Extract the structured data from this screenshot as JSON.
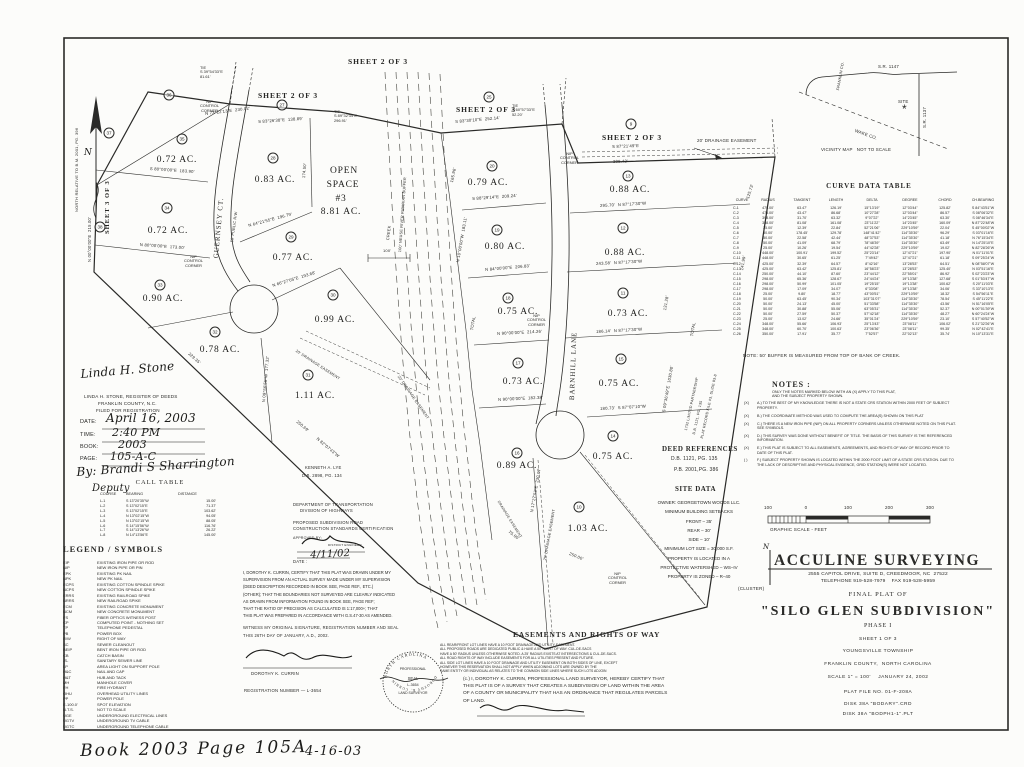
{
  "sheet_refs": {
    "s2": "SHEET 2 OF 3",
    "s3": "SHEET 3 OF 3"
  },
  "north_note": "NORTH RELATIVE TO B.M. 2001, PG. 396",
  "north_n": "N",
  "map": {
    "streets": {
      "guernsey": "GUERNSEY CT.",
      "guernsey_rw": "50' PUBLIC R/W",
      "barnhill": "BARNHILL LANE"
    },
    "creek": {
      "label": "CREEK",
      "buffer": "100' NEUSE RIVER RIPARIAN BUFFER",
      "dim": "100'"
    },
    "easements": {
      "e20": "20' DRAINAGE EASEMENT",
      "e25": "25' DRAINAGE EASEMENT",
      "edr": "DRAINAGE EASEMENT"
    },
    "control_corner": {
      "l1": "NIP",
      "l2": "CONTROL",
      "l3": "CORNER"
    },
    "ties": {
      "t1": [
        "TIE",
        "S 39°54'33\"E",
        "81.61'"
      ],
      "t2": [
        "TIE",
        "S 89°32'34\"E",
        "296.91'"
      ],
      "t3": [
        "TIE",
        "S 60°57'33\"E",
        "52.20'"
      ]
    },
    "adjoiners": {
      "lye1": "KENNETH A. LYE",
      "lye2": "D.B. 2898, PG. 134",
      "lp1": "1732 LIMITED PARTNERSHIP",
      "lp2": "D.B. 1121, PG. 135",
      "lp3": "PLAT RECORD FILE #3, SLIDE 83-8"
    },
    "open_space": {
      "l1": "OPEN",
      "l2": "SPACE",
      "l3": "#3",
      "l4": "8.81 AC."
    },
    "bearings": [
      "N 73°22'13\"E  230.02'",
      "S 80°00'00\"E  183.90'",
      "N 80°00'00\"E  173.00'",
      "S 83°26'38\"E  138.89'",
      "N 64°21'55\"E  196.79'",
      "N 66°27'05\"E  193.68'",
      "S 83°30'10\"E  252.14'",
      "S 88°29'14\"E  209.24'",
      "N 84°00'00\"E  206.83'",
      "N 90°00'00\"E  214.26'",
      "N 90°00'00\"E  182.38'",
      "S 87°21'49\"E",
      "308.42'",
      "295.70'  N 87°17'30\"W",
      "243.58'  N 87°17'30\"W",
      "186.14'  N 87°17'30\"W",
      "180.73'  S 87°07'10\"W",
      "N 00°00'00\"E  215.00'",
      "N 10°00'00\"W  183.11'",
      "174.50'",
      "165.96'",
      "229.35'",
      "250.69'",
      "250.00'",
      "75.00'",
      "N 82°07'43\"W",
      "S 09°36'49\"E  1030.80'",
      "141.99'",
      "125.73'",
      "131.28'",
      "TOTAL",
      "TOTAL",
      "N 17°27'53\"E  230.07'",
      "N 09°56'55\"W  177.32'"
    ],
    "lots": [
      {
        "num": "35",
        "area": "0.72 AC."
      },
      {
        "num": "34",
        "area": "0.72 AC."
      },
      {
        "num": "33",
        "area": "0.90 AC."
      },
      {
        "num": "32",
        "area": "0.78 AC."
      },
      {
        "num": "31",
        "area": "1.11 AC."
      },
      {
        "num": "30",
        "area": "0.99 AC."
      },
      {
        "num": "29",
        "area": "0.77 AC."
      },
      {
        "num": "28",
        "area": "0.83 AC."
      },
      {
        "num": "20",
        "area": "0.79 AC."
      },
      {
        "num": "19",
        "area": "0.80 AC."
      },
      {
        "num": "18",
        "area": "0.75 AC."
      },
      {
        "num": "17",
        "area": "0.73 AC."
      },
      {
        "num": "16",
        "area": "0.89 AC."
      },
      {
        "num": "13",
        "area": "0.88 AC."
      },
      {
        "num": "12",
        "area": "0.88 AC."
      },
      {
        "num": "11",
        "area": "0.73 AC."
      },
      {
        "num": "15",
        "area": "0.75 AC."
      },
      {
        "num": "14",
        "area": "0.75 AC."
      },
      {
        "num": "10",
        "area": "1.03 AC."
      },
      {
        "num": "36"
      },
      {
        "num": "37"
      },
      {
        "num": "38"
      },
      {
        "num": "27"
      },
      {
        "num": "25"
      },
      {
        "num": "9"
      }
    ]
  },
  "vicinity": {
    "r1": "S.R. 1147",
    "r2": "S.R. 1137",
    "site": "SITE",
    "star": "*",
    "county1": "WAKE CO.",
    "county2": "FRANKLIN CO.",
    "caption": "VICINITY MAP   NOT TO SCALE"
  },
  "curve_table": {
    "title": "CURVE DATA TABLE",
    "headers": [
      "CURVE",
      "RADIUS",
      "TANGENT",
      "LENGTH",
      "DELTA",
      "DEGREE",
      "CHORD",
      "CH.BEARING"
    ],
    "rows": [
      {
        "c": "C-1",
        "r": "475.00'",
        "t": "63.47'",
        "l": "126.19'",
        "d": "15°13'19\"",
        "g": "12°03'44\"",
        "h": "125.82'",
        "b": "S 84°43'51\"W"
      },
      {
        "c": "C-2",
        "r": "475.00'",
        "t": "43.47'",
        "l": "86.68'",
        "d": "10°27'28\"",
        "g": "12°03'44\"",
        "h": "86.57'",
        "b": "S 08°06'32\"E"
      },
      {
        "c": "C-3",
        "r": "398.00'",
        "t": "31.70'",
        "l": "63.32'",
        "d": "9°07'22\"",
        "g": "14°23'45\"",
        "h": "63.30'",
        "b": "S 08°46'34\"E"
      },
      {
        "c": "C-4",
        "r": "358.00'",
        "t": "81.08'",
        "l": "161.08'",
        "d": "23°11'22\"",
        "g": "14°23'45\"",
        "h": "160.09'",
        "b": "N 87°22'48\"W"
      },
      {
        "c": "C-5",
        "r": "25.00'",
        "t": "12.39'",
        "l": "22.84'",
        "d": "52°21'06\"",
        "g": "229°10'59\"",
        "h": "22.04'",
        "b": "S 45°00'02\"W"
      },
      {
        "c": "C-6",
        "r": "50.00'",
        "t": "178.45'",
        "l": "129.78'",
        "d": "148°41'42\"",
        "g": "114°35'30\"",
        "h": "96.29'",
        "b": "S 03°01'16\"E"
      },
      {
        "c": "C-7",
        "r": "50.00'",
        "t": "22.58'",
        "l": "42.44'",
        "d": "48°37'53\"",
        "g": "114°35'30\"",
        "h": "41.18'",
        "b": "N 76°15'34\"E"
      },
      {
        "c": "C-8",
        "r": "50.00'",
        "t": "41.09'",
        "l": "68.79'",
        "d": "78°48'39\"",
        "g": "114°35'30\"",
        "h": "63.49'",
        "b": "N 14°25'10\"E"
      },
      {
        "c": "C-9",
        "r": "25.00'",
        "t": "10.26'",
        "l": "19.54'",
        "d": "44°42'28\"",
        "g": "229°10'59\"",
        "h": "19.02'",
        "b": "N 82°28'26\"W"
      },
      {
        "c": "C-10",
        "r": "448.00'",
        "t": "100.91'",
        "l": "199.52'",
        "d": "25°23'14\"",
        "g": "12°47'21\"",
        "h": "197.90'",
        "b": "N 01°11'01\"E"
      },
      {
        "c": "C-11",
        "r": "448.00'",
        "t": "30.65'",
        "l": "61.25'",
        "d": "7°49'42\"",
        "g": "12°47'21\"",
        "h": "61.18'",
        "b": "S 09°25'24\"W"
      },
      {
        "c": "C-12",
        "r": "425.00'",
        "t": "32.39'",
        "l": "64.57'",
        "d": "8°42'16\"",
        "g": "13°28'53\"",
        "h": "64.51'",
        "b": "N 08°58'07\"W"
      },
      {
        "c": "C-13",
        "r": "425.00'",
        "t": "63.42'",
        "l": "125.81'",
        "d": "16°58'23\"",
        "g": "13°28'53\"",
        "h": "125.40'",
        "b": "N 03°51'16\"E"
      },
      {
        "c": "C-14",
        "r": "250.00'",
        "t": "44.10'",
        "l": "87.60'",
        "d": "23°44'12\"",
        "g": "22°55'01\"",
        "h": "86.92'",
        "b": "S 02°23'23\"W"
      },
      {
        "c": "C-15",
        "r": "298.00'",
        "t": "65.36'",
        "l": "128.67'",
        "d": "24°44'24\"",
        "g": "19°13'38\"",
        "h": "127.68'",
        "b": "S 01°53'47\"W"
      },
      {
        "c": "C-16",
        "r": "298.00'",
        "t": "50.99'",
        "l": "101.05'",
        "d": "19°25'15\"",
        "g": "19°13'38\"",
        "h": "100.62'",
        "b": "S 20°11'03\"E"
      },
      {
        "c": "C-17",
        "r": "298.00'",
        "t": "17.09'",
        "l": "34.07'",
        "d": "6°33'08\"",
        "g": "19°13'38\"",
        "h": "34.06'",
        "b": "S 33°10'13\"E"
      },
      {
        "c": "C-18",
        "r": "25.00'",
        "t": "9.80'",
        "l": "18.77'",
        "d": "43°00'51\"",
        "g": "229°10'59\"",
        "h": "18.32'",
        "b": "S 54°56'11\"E"
      },
      {
        "c": "C-19",
        "r": "50.00'",
        "t": "63.45'",
        "l": "90.34'",
        "d": "103°31'07\"",
        "g": "114°35'30\"",
        "h": "78.54'",
        "b": "S 45°11'22\"E"
      },
      {
        "c": "C-20",
        "r": "50.00'",
        "t": "24.13'",
        "l": "45.00'",
        "d": "51°33'58\"",
        "g": "114°35'30\"",
        "h": "43.56'",
        "b": "N 51°16'05\"E"
      },
      {
        "c": "C-21",
        "r": "50.00'",
        "t": "30.88'",
        "l": "55.06'",
        "d": "63°05'31\"",
        "g": "114°35'30\"",
        "h": "52.37'",
        "b": "N 00°01'39\"W"
      },
      {
        "c": "C-22",
        "r": "50.00'",
        "t": "27.59'",
        "l": "50.37'",
        "d": "57°42'18\"",
        "g": "114°35'30\"",
        "h": "48.27'",
        "b": "N 60°24'24\"W"
      },
      {
        "c": "C-23",
        "r": "25.00'",
        "t": "13.02'",
        "l": "24.66'",
        "d": "35°01'24\"",
        "g": "229°10'59\"",
        "h": "23.10'",
        "b": "S 57°40'52\"W"
      },
      {
        "c": "C-24",
        "r": "348.00'",
        "t": "55.66'",
        "l": "106.93'",
        "d": "25°13'43\"",
        "g": "23°08'11\"",
        "h": "106.02'",
        "b": "S 21°32'26\"W"
      },
      {
        "c": "C-25",
        "r": "348.00'",
        "t": "60.70'",
        "l": "100.63'",
        "d": "23°06'36\"",
        "g": "23°08'11\"",
        "h": "99.35'",
        "b": "N 02°42'41\"E"
      },
      {
        "c": "C-26",
        "r": "350.00'",
        "t": "17.91'",
        "l": "35.77'",
        "d": "7°52'57\"",
        "g": "22°02'13\"",
        "h": "35.74'",
        "b": "N 10°13'31\"E"
      }
    ]
  },
  "buffer_note": "NOTE: 50' BUFFER IS MEASURED FROM TOP OF BANK OF CREEK.",
  "notes": {
    "title": "NOTES :",
    "intro1": "ONLY THE NOTES MARKED BELOW WITH AN (X) APPLY TO THIS PLAT,",
    "intro2": "AND THE SUBJECT PROPERTY SHOWN.",
    "items": [
      {
        "mark": "(X)",
        "text": "A.) TO THE BEST OF MY KNOWLEDGE THERE IS NOT A STATE CRS STATION WITHIN 2000 FEET OF SUBJECT PROPERTY."
      },
      {
        "mark": "(X)",
        "text": "B.) THE COORDINATE METHOD WAS USED TO COMPUTE THE AREA(S) SHOWN ON THIS PLAT"
      },
      {
        "mark": "(X)",
        "text": "C.) THERE IS A NEW IRON PIPE (NIP) ON ALL PROPERTY CORNERS UNLESS OTHERWISE NOTED ON THIS PLAT. SEE SYMBOLS."
      },
      {
        "mark": "(X)",
        "text": "D.) THIS SURVEY WAS DONE WITHOUT BENEFIT OF TITLE. THE BASIS OF THIS SURVEY IS THE REFERENCED INFORMATION."
      },
      {
        "mark": "(X)",
        "text": "E.) THIS PLAT IS SUBJECT TO ALL EASEMENTS, AGREEMENTS, AND RIGHTS OF WAY OF RECORD PRIOR TO DATE OF THIS PLAT."
      },
      {
        "mark": "(  )",
        "text": "F.) SUBJECT PROPERTY SHOWN IS LOCATED WITHIN THE 2000 FOOT LIMIT OF A STATE CRS STATION. DUE TO THE LACK OF DESCRIPTIVE AND PHYSICAL EVIDENCE, GRID STATION(S) WERE NOT LOCATED."
      }
    ]
  },
  "deed_refs": {
    "title": "DEED REFERENCES",
    "l1": "D.B. 1121, PG. 135",
    "l2": "P.B. 2001,PG. 386"
  },
  "site_data": {
    "title": "SITE DATA",
    "lines": [
      "OWNER: GEORGETOWN WOODS LLC.",
      "MINIMUM BUILDING SETBACKS",
      "FRONT – 35'",
      "REAR – 30'",
      "SIDE – 10'",
      "MINIMUM LOT SIZE = 30,000 S.F.",
      "PROPERTY IS LOCATED IN A",
      "PROTECTIVE WATERSHED – WS–IV",
      "PROPERTY IS ZONED – R–40"
    ],
    "cluster": "(CLUSTER)"
  },
  "scale_bar": {
    "labels": [
      "100",
      "0",
      "100",
      "200",
      "300"
    ],
    "caption": "GRAPHIC SCALE - FEET"
  },
  "call_table": {
    "title": "CALL TABLE",
    "headers": [
      "COURSE",
      "BEARING",
      "DISTANCE"
    ],
    "rows": [
      {
        "course": "L-1",
        "bearing": "S 13°20'35\"W",
        "distance": "15.00'"
      },
      {
        "course": "L-2",
        "bearing": "S 13°02'15\"E",
        "distance": "71.37'"
      },
      {
        "course": "L-3",
        "bearing": "S 13°02'15\"E",
        "distance": "103.62'"
      },
      {
        "course": "L-4",
        "bearing": "N 13°02'15\"W",
        "distance": "94.05'"
      },
      {
        "course": "L-5",
        "bearing": "N 13°02'15\"W",
        "distance": "88.05'"
      },
      {
        "course": "L-6",
        "bearing": "S 14°15'56\"W",
        "distance": "116.76'"
      },
      {
        "course": "L-7",
        "bearing": "S 14°13'26\"W",
        "distance": "26.22'"
      },
      {
        "course": "L-8",
        "bearing": "N 14°13'56\"E",
        "distance": "145.00'"
      }
    ]
  },
  "legend": {
    "title": "LEGEND / SYMBOLS",
    "items": [
      {
        "abbr": "EIP",
        "desc": "EXISTING IRON PIPE OR ROD"
      },
      {
        "abbr": "NIP",
        "desc": "NEW IRON PIPE OR PIN"
      },
      {
        "abbr": "EPK",
        "desc": "EXISTING PK NAIL"
      },
      {
        "abbr": "NPK",
        "desc": "NEW PK NAIL"
      },
      {
        "abbr": "ECPS",
        "desc": "EXISTING COTTON SPINDLE SPIKE"
      },
      {
        "abbr": "NCPS",
        "desc": "NEW COTTON SPINDLE SPIKE"
      },
      {
        "abbr": "ERRS",
        "desc": "EXISTING RAILROAD SPIKE"
      },
      {
        "abbr": "NRRS",
        "desc": "NEW RAILROAD SPIKE"
      },
      {
        "abbr": "ECM",
        "desc": "EXISTING CONCRETE MONUMENT"
      },
      {
        "abbr": "NCM",
        "desc": "NEW CONCRETE MONUMENT"
      },
      {
        "abbr": "FS",
        "desc": "FIBER OPTICS WITNESS POST"
      },
      {
        "abbr": "CP",
        "desc": "COMPUTED POINT - NOTHING SET"
      },
      {
        "abbr": "TP",
        "desc": "TELEPHONE PEDESTAL"
      },
      {
        "abbr": "PB",
        "desc": "POWER BOX"
      },
      {
        "abbr": "R/W",
        "desc": "RIGHT OF WAY"
      },
      {
        "abbr": "SC",
        "desc": "SEWER CLEANOUT"
      },
      {
        "abbr": "BEIP",
        "desc": "BENT IRON PIPE OR ROD"
      },
      {
        "abbr": "CB",
        "desc": "CATCH BASIN"
      },
      {
        "abbr": "-S-",
        "desc": "SANITARY SEWER LINE"
      },
      {
        "abbr": "LP",
        "desc": "AREA LIGHT ON SUPPORT POLE"
      },
      {
        "abbr": "H&C",
        "desc": "NAIL AND CAP"
      },
      {
        "abbr": "H&T",
        "desc": "HUB AND TACK"
      },
      {
        "abbr": "MH",
        "desc": "MANHOLE COVER"
      },
      {
        "abbr": "FH",
        "desc": "FIRE HYDRANT"
      },
      {
        "abbr": "OHU",
        "desc": "OVERHEAD UTILITY LINES"
      },
      {
        "abbr": "PP",
        "desc": "POWER POLE"
      },
      {
        "abbr": "E-100.0'",
        "desc": "SPOT ELEVATION"
      },
      {
        "abbr": "N.T.S.",
        "desc": "NOT TO SCALE"
      },
      {
        "abbr": "UGE",
        "desc": "UNDERGROUND ELECTRICAL LINES"
      },
      {
        "abbr": "UGTV",
        "desc": "UNDERGROUND TV CABLE"
      },
      {
        "abbr": "UGTC",
        "desc": "UNDERGROUND TELEPHONE CABLE"
      }
    ]
  },
  "registration": {
    "sig": "Linda H. Stone",
    "l1": "LINDA H. STONE, REGISTER OF DEEDS",
    "l2": "FRANKLIN COUNTY, N.C.",
    "l3": "FILED FOR REGISTRATION",
    "date_label": "DATE:",
    "date_value": "April 16, 2003",
    "time_label": "TIME:",
    "time_value": "2:40 PM",
    "book_label": "BOOK:",
    "book_value": "2003",
    "page_label": "PAGE:",
    "page_value": "105-A-C",
    "by": "By: Brandi S Sharrington",
    "deputy": "Deputy"
  },
  "dot_cert": {
    "l1": "DEPARTMENT OF TRANSPORTATION",
    "l2": "DIVISION OF HIGHWAYS",
    "l3": "PROPOSED SUBDIVISION ROAD",
    "l4": "CONSTRUCTION STANDARDS CERTIFICATION",
    "approved": "APPROVED BY:",
    "engineer": "DISTRICT ENGINEER",
    "date_label": "DATE :",
    "date_value": "4/11/02"
  },
  "surveyor_cert": {
    "lines": [
      "I, DOROTHY K. CURRIN, CERTIFY THAT THIS PLAT WAS DRAWN UNDER MY",
      "SUPERVISION FROM AN ACTUAL SURVEY MADE UNDER MY SUPERVISION",
      "(DEED DESCRIPTION RECORDED IN BOOK SEE, PAGE REF., ETC.)",
      "(OTHER); THAT THE BOUNDARIES NOT SURVEYED ARE CLEARLY INDICATED",
      "AS DRAWN FROM INFORMATION FOUND IN BOOK SEE, PAGE REF;",
      "THAT THE RATIO OF PRECISION AS CALCULATED IS 1:17,000+; THAT",
      "THIS PLAT WAS PREPARED IN ACCORDANCE WITH G.S.47-30 AS AMENDED."
    ],
    "witness1": "WITNESS MY ORIGINAL SIGNATURE, REGISTRATION NUMBER AND SEAL",
    "witness2": "THIS 26TH DAY OF JANUARY, A.D., 2002.",
    "name": "DOROTHY K. CURRIN",
    "reg": "REGISTRATION NUMBER — L-3654",
    "seal": {
      "arc_top": "NORTH CAROLINA",
      "mid1": "PROFESSIONAL",
      "mid2": "SEAL",
      "mid3": "L-3654",
      "mid4": "LAND SURVEYOR",
      "arc_bottom": "DOROTHY K. CURRIN"
    }
  },
  "easement_cert": {
    "title": "EASEMENTS AND RIGHTS OF WAY",
    "lines": [
      "ALL REAR/FRONT LOT LINES HAVE A 10 FOOT DRAINAGE AND UTILITY EASEMENT.",
      "ALL PROPOSED ROADS ARE DEDICATED PUBLIC & HAVE A 50' RIGHT OF WAY. CUL-DE-SACS",
      "HAVE A 50' RADIUS UNLESS OTHERWISE NOTED. A 25' RADIUS EXISTS AT INTERSECTIONS & CUL-DE-SACS.",
      "ALL ROAD RIGHTS OF WAY INCLUDE EASEMENTS FOR ALL UTILITIES PRESENT AND FUTURE.",
      "ALL SIDE LOT LINES HAVE A 10 FOOT DRAINAGE AND UTILITY EASEMENT ON BOTH SIDES OF LINE, EXCEPT",
      "HOWEVER THIS RESERVATION SHALL NOT APPLY WHEN ADJOINING LOTS ARE OWNED BY THE",
      "SAME ENTITY OR INDIVIDUAL AS RELATES TO THE COMMON SIDE LINES WHERE SUCH LOTS ADJOIN"
    ],
    "sub_cert": [
      "(c.) I, DOROTHY K. CURRIN, PROFESSIONAL LAND SURVEYOR, HEREBY CERTIFY THAT",
      "THIS PLAT IS OF A SURVEY THAT CREATES A SUBDIVISION OF LAND WITHIN THE AREA",
      "OF A COUNTY OR MUNICIPALITY THAT HAS AN ORDINANCE THAT REGULATES PARCELS",
      "OF LAND."
    ]
  },
  "title_block": {
    "n": "N",
    "firm": "ACCULINE SURVEYING",
    "address": "2555 CAPITOL DRIVE, SUITE D, CREEDMOOR, NC  27522",
    "phone": "TELEPHONE 919-528-7979    FAX 919-528-5959",
    "final": "FINAL PLAT OF",
    "name": "\"SILO GLEN SUBDIVISION\"",
    "phase": "PHASE I",
    "sheet": "SHEET 1 OF 3",
    "township": "YOUNGSVILLE TOWNSHIP",
    "county": "FRANKLIN COUNTY,  NORTH CAROLINA",
    "scale_date": "SCALE 1\" = 100'    JANUARY 24, 2002",
    "plat_file": "PLAT FILE NO. 01-F-208A",
    "disk1": "DISK 38A \"BODARY\".CRD",
    "disk2": "DISK 38A \"BODPH1-1\".PLT"
  },
  "handwriting": {
    "book": "Book 2003 Page 105A",
    "date": "4-16-03"
  }
}
